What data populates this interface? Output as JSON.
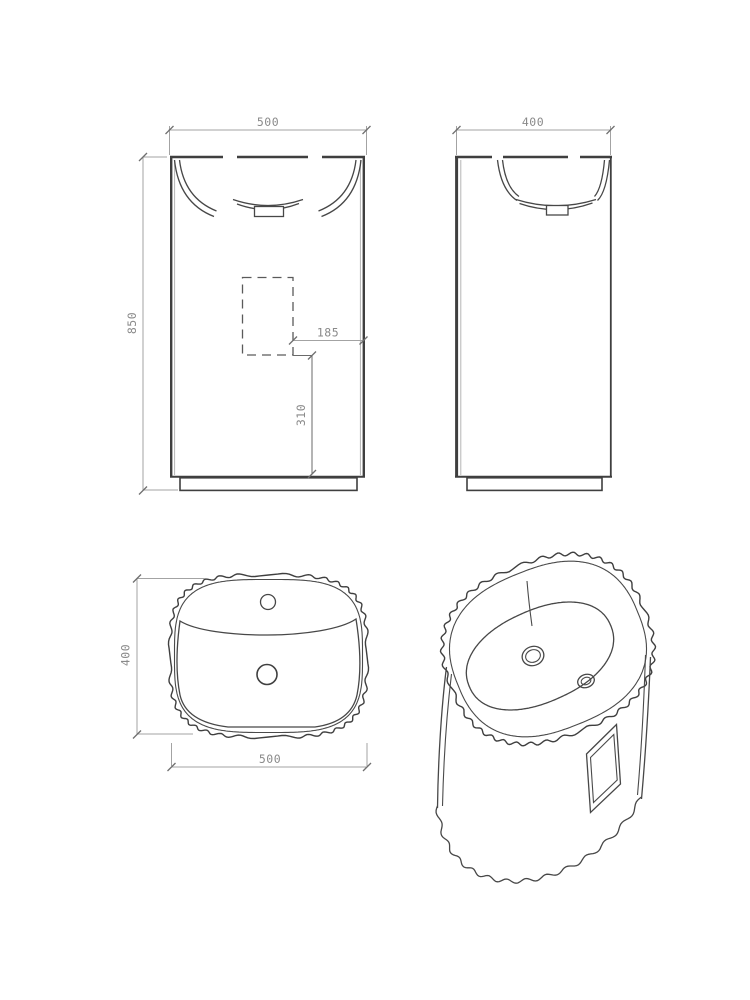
{
  "drawing": {
    "type": "technical-drawing-pedestal-basin",
    "front_view": {
      "width": "500",
      "height": "850",
      "drain_offset": "185",
      "drain_height": "310"
    },
    "side_view": {
      "depth": "400"
    },
    "top_view": {
      "depth": "400",
      "width": "500"
    },
    "colors": {
      "object_line": "#3f3f3f",
      "dimension_line": "#a3a3a3",
      "dimension_text": "#8a8a8a",
      "background": "#ffffff"
    }
  }
}
